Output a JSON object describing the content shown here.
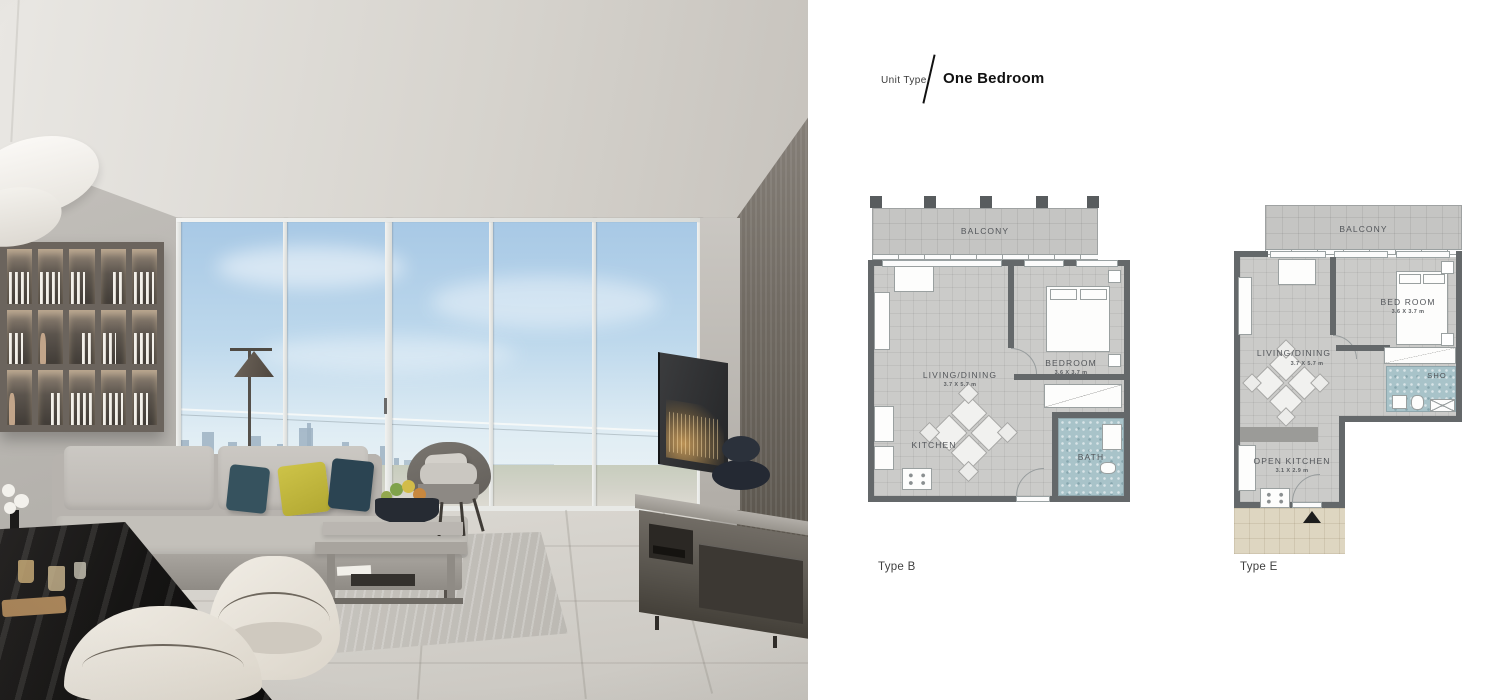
{
  "page": {
    "background": "#ffffff"
  },
  "header": {
    "label": "Unit Type",
    "title": "One Bedroom"
  },
  "plans": [
    {
      "caption": "Type B",
      "rooms": {
        "balcony": {
          "name": "BALCONY"
        },
        "living": {
          "name": "LIVING/DINING",
          "dims": "3.7 X 5.7 m"
        },
        "bedroom": {
          "name": "BEDROOM",
          "dims": "3.6 X 3.7 m"
        },
        "kitchen": {
          "name": "KITCHEN"
        },
        "bath": {
          "name": "BATH"
        }
      }
    },
    {
      "caption": "Type E",
      "rooms": {
        "balcony": {
          "name": "BALCONY"
        },
        "bedroom": {
          "name": "BED ROOM",
          "dims": "3.6 X 3.7 m"
        },
        "living": {
          "name": "LIVING/DINING",
          "dims": "3.7 X 5.7 m"
        },
        "shower": {
          "name": "SHO"
        },
        "kitchen": {
          "name": "OPEN KITCHEN",
          "dims": "3.1 X 2.9 m"
        }
      }
    }
  ],
  "colors": {
    "plan_wall": "#64686a",
    "plan_floor": "#cbcbc9",
    "plan_balcony": "#c5c5c3",
    "plan_bath": "#a8c3c9",
    "plan_entry": "#ded6c1",
    "label_text": "#53565a",
    "pillow_yellow": "#c4ba3e",
    "pillow_teal": "#33505c"
  }
}
